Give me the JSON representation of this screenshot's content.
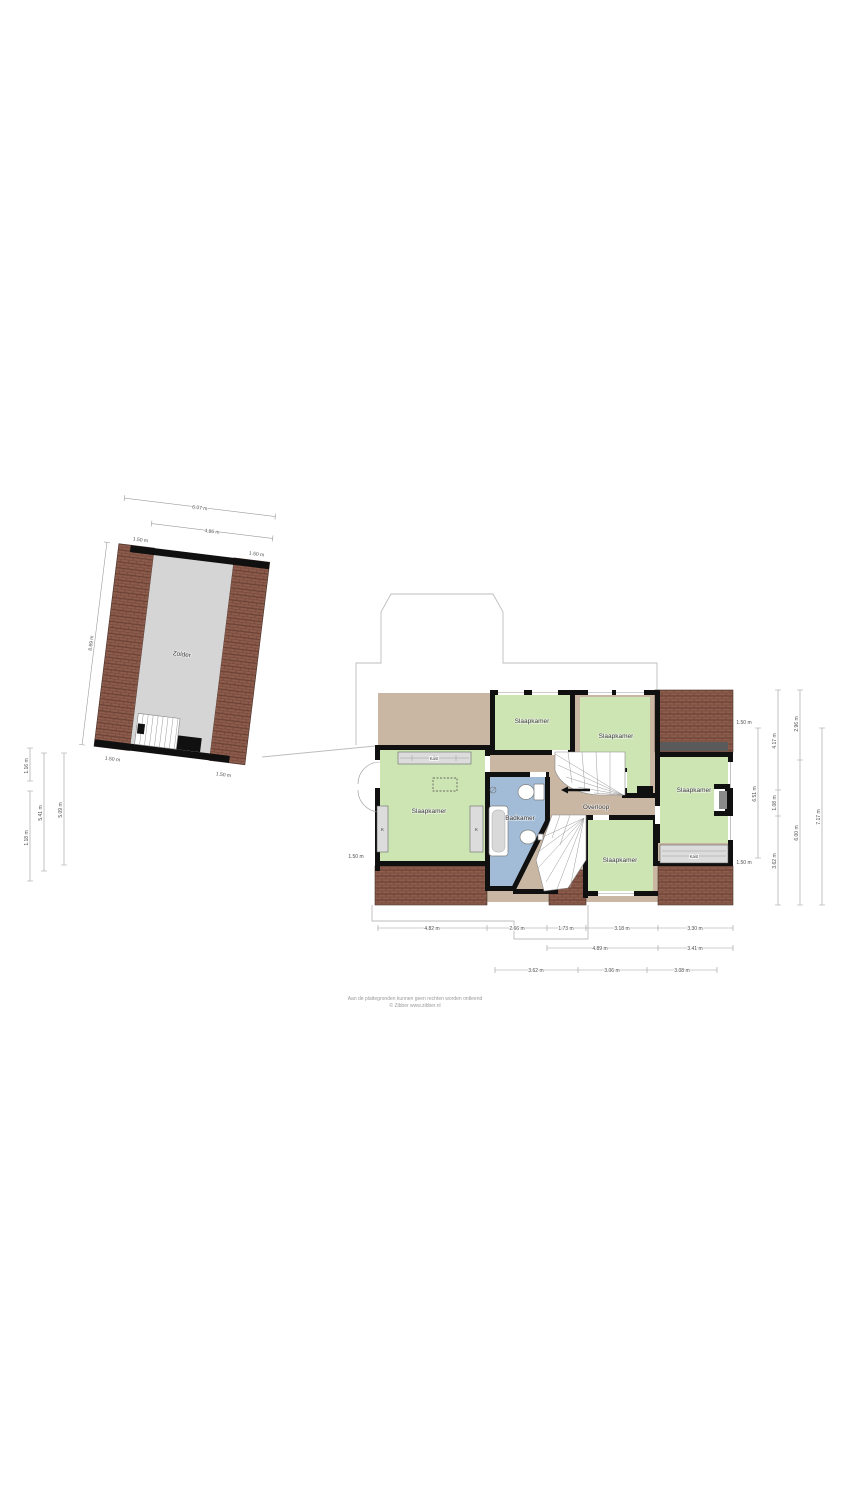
{
  "colors": {
    "bedroom_green": "#cde4b3",
    "bathroom_blue": "#a2bcd8",
    "landing_tan": "#c9b7a3",
    "roof_brick": "#8d5c4c",
    "attic_gray": "#d5d5d5"
  },
  "attic": {
    "room_label": "Zolder",
    "dim_outer_width": "6.07 m",
    "dim_inner_width": "4.86 m",
    "dim_top_left": "1.50 m",
    "dim_top_right": "1.50 m",
    "dim_left_height": "8.69 m",
    "dim_bottom_left": "1.50 m",
    "dim_bottom_right": "1.50 m",
    "dim_side_seg_top": "1.16 m",
    "dim_side_seg_bottom": "1.18 m",
    "dim_side_total": "5.41 m",
    "dim_side_inner": "5.09 m"
  },
  "floor": {
    "room_bedroom_left": "Slaapkamer",
    "room_bedroom_top": "Slaapkamer",
    "room_bedroom_middle": "Slaapkamer",
    "room_bedroom_right": "Slaapkamer",
    "room_bedroom_bottom": "Slaapkamer",
    "room_bathroom": "Badkamer",
    "room_landing": "Overloop",
    "closet_top": "Kast",
    "closet_right": "Kast",
    "closet_k_left": "K",
    "closet_k_right": "K",
    "dim_roof_left": "1.50 m",
    "dims_bottom_row1": [
      "4.82 m",
      "2.66 m",
      "1.73 m",
      "3.18 m",
      "3.30 m"
    ],
    "dims_bottom_row2": [
      "4.89 m",
      "3.41 m"
    ],
    "dims_bottom_row3": [
      "3.62 m",
      "3.06 m",
      "3.08 m"
    ],
    "dim_right_roof_top": "1.50 m",
    "dim_right_room_height": "6.51 m",
    "dim_right_roof_bottom": "1.50 m",
    "dim_right2_top": "4.17 m",
    "dim_right2_mid": "1.08 m",
    "dim_right2_bottom": "3.62 m",
    "dim_right3_top": "2.96 m",
    "dim_right3_bottom": "6.00 m",
    "dim_right4_total": "7.17 m"
  },
  "footer": {
    "line1": "Aan de plattegronden kunnen geen rechten worden ontleend",
    "line2": "© Zibber www.zibber.nl"
  }
}
